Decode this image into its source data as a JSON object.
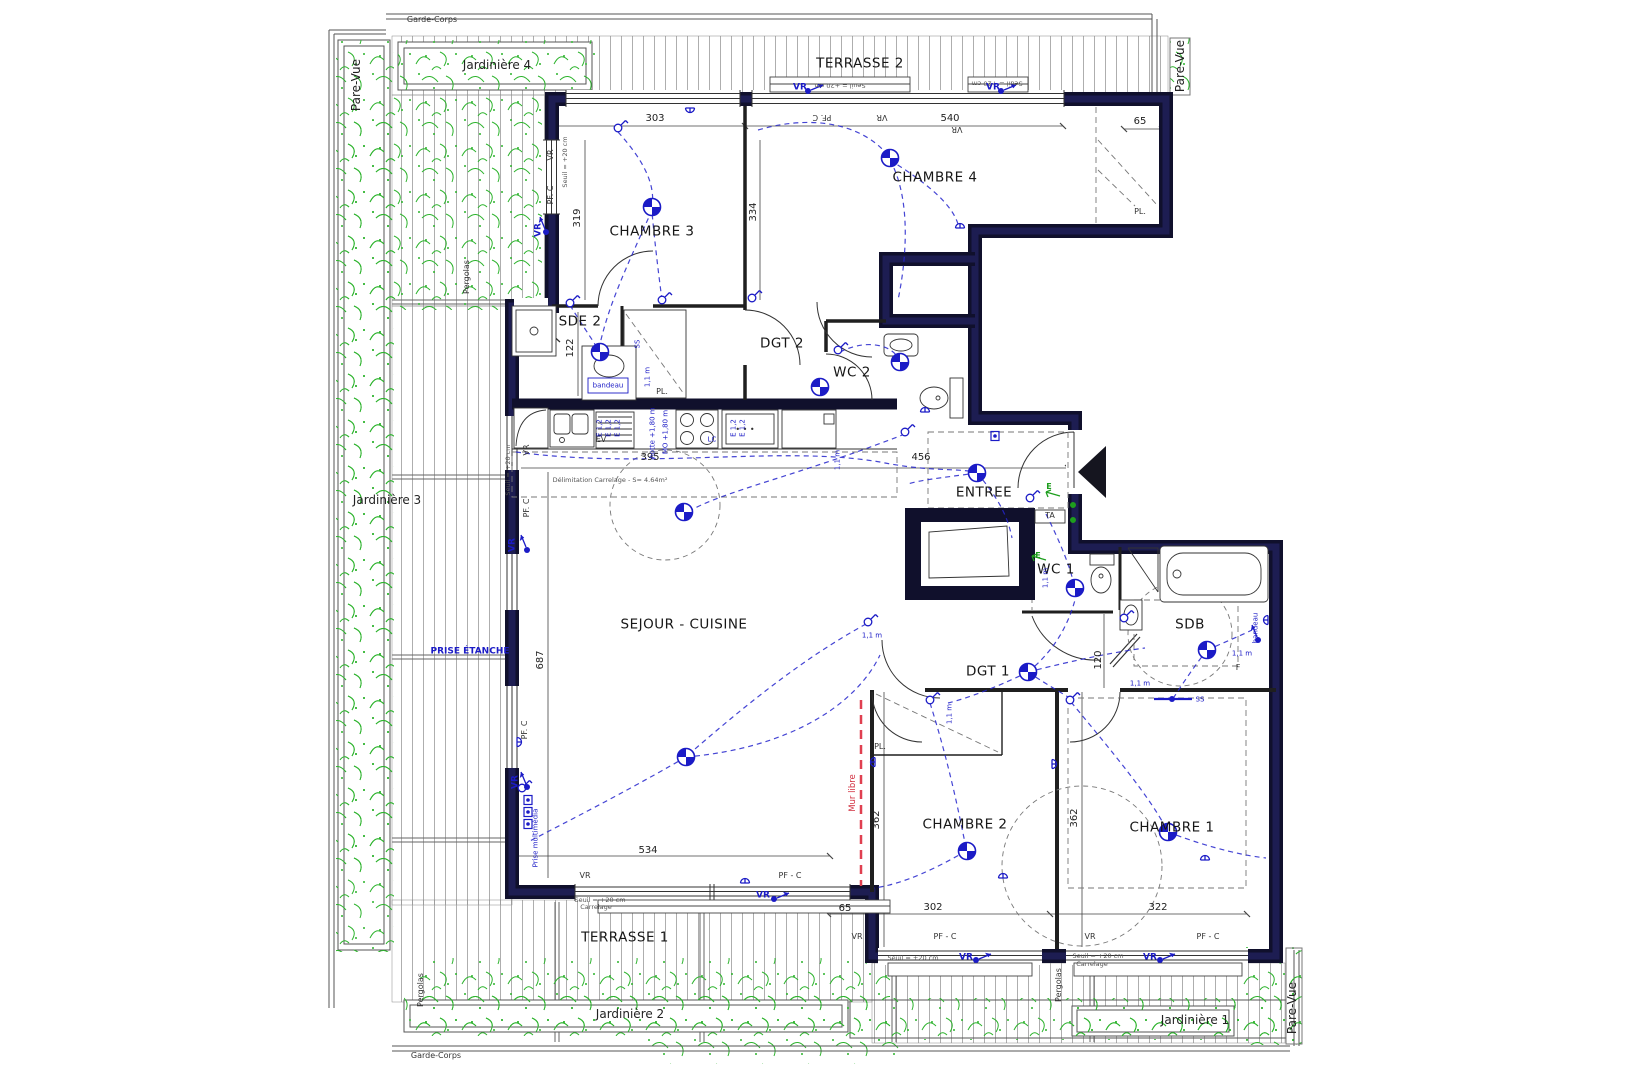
{
  "drawing": {
    "type": "floor-plan",
    "rooms": [
      "CHAMBRE 1",
      "CHAMBRE 2",
      "CHAMBRE 3",
      "CHAMBRE 4",
      "SEJOUR - CUISINE",
      "ENTREE",
      "DGT 1",
      "DGT 2",
      "WC 1",
      "WC 2",
      "SDE 2",
      "SDB"
    ],
    "outdoor": [
      "TERRASSE 1",
      "TERRASSE 2",
      "Jardinière 1",
      "Jardinière 2",
      "Jardinière 3",
      "Jardinière 4",
      "Pare-Vue",
      "Garde-Corps",
      "Pergolas"
    ],
    "dimensions_cm": [
      303,
      540,
      65,
      319,
      334,
      122,
      395,
      456,
      687,
      534,
      65,
      302,
      322,
      362,
      362,
      120
    ],
    "icons": [
      "ceiling-light-icon",
      "wall-switch-icon",
      "power-socket-icon",
      "roller-shutter-control-icon",
      "multimedia-socket-icon",
      "entrance-arrow-icon"
    ],
    "colors": {
      "wall": "#10102c",
      "electric": "#1b1bc6",
      "vegetation": "#2db32d",
      "deck_line": "#999999",
      "mur_libre": "#e04050"
    }
  },
  "labels": [
    {
      "t": "CHAMBRE 3",
      "x": 652,
      "y": 232,
      "c": "room"
    },
    {
      "t": "CHAMBRE 4",
      "x": 935,
      "y": 178,
      "c": "room"
    },
    {
      "t": "SDE 2",
      "x": 580,
      "y": 322,
      "c": "room"
    },
    {
      "t": "DGT 2",
      "x": 782,
      "y": 344,
      "c": "room"
    },
    {
      "t": "WC 2",
      "x": 852,
      "y": 373,
      "c": "room"
    },
    {
      "t": "ENTREE",
      "x": 984,
      "y": 493,
      "c": "room"
    },
    {
      "t": "SEJOUR - CUISINE",
      "x": 684,
      "y": 625,
      "c": "room"
    },
    {
      "t": "WC 1",
      "x": 1056,
      "y": 570,
      "c": "room"
    },
    {
      "t": "SDB",
      "x": 1190,
      "y": 625,
      "c": "room"
    },
    {
      "t": "DGT 1",
      "x": 988,
      "y": 672,
      "c": "room"
    },
    {
      "t": "CHAMBRE 2",
      "x": 965,
      "y": 825,
      "c": "room"
    },
    {
      "t": "CHAMBRE 1",
      "x": 1172,
      "y": 828,
      "c": "room"
    },
    {
      "t": "TERRASSE 2",
      "x": 860,
      "y": 64,
      "c": "room"
    },
    {
      "t": "TERRASSE 1",
      "x": 625,
      "y": 938,
      "c": "room"
    },
    {
      "t": "Jardinière 4",
      "x": 497,
      "y": 65,
      "c": "big"
    },
    {
      "t": "Jardinière 3",
      "x": 387,
      "y": 500,
      "c": "big"
    },
    {
      "t": "Jardinière 2",
      "x": 630,
      "y": 1014,
      "c": "big"
    },
    {
      "t": "Jardinière 1",
      "x": 1195,
      "y": 1020,
      "c": "big"
    },
    {
      "t": "Pare-Vue",
      "x": 356,
      "y": 85,
      "c": "big",
      "r": 90
    },
    {
      "t": "Pare-Vue",
      "x": 1180,
      "y": 66,
      "c": "big",
      "r": 90
    },
    {
      "t": "Pare-Vue",
      "x": 1292,
      "y": 1008,
      "c": "big",
      "r": 90
    },
    {
      "t": "Garde-Corps",
      "x": 432,
      "y": 20,
      "c": "tiny"
    },
    {
      "t": "Garde-Corps",
      "x": 436,
      "y": 1056,
      "c": "tiny"
    },
    {
      "t": "Pergolas",
      "x": 467,
      "y": 277,
      "c": "tiny",
      "r": 90
    },
    {
      "t": "Pergolas",
      "x": 421,
      "y": 990,
      "c": "tiny",
      "r": 90
    },
    {
      "t": "Pergolas",
      "x": 1059,
      "y": 985,
      "c": "tiny",
      "r": 90
    },
    {
      "t": "303",
      "x": 655,
      "y": 119,
      "c": "dim"
    },
    {
      "t": "540",
      "x": 950,
      "y": 119,
      "c": "dim"
    },
    {
      "t": "65",
      "x": 1140,
      "y": 122,
      "c": "dim"
    },
    {
      "t": "319",
      "x": 578,
      "y": 218,
      "c": "dim",
      "r": 90
    },
    {
      "t": "334",
      "x": 754,
      "y": 212,
      "c": "dim",
      "r": 90
    },
    {
      "t": "122",
      "x": 571,
      "y": 348,
      "c": "dim",
      "r": 90
    },
    {
      "t": "395",
      "x": 650,
      "y": 458,
      "c": "dim"
    },
    {
      "t": "456",
      "x": 921,
      "y": 458,
      "c": "dim"
    },
    {
      "t": "687",
      "x": 541,
      "y": 660,
      "c": "dim",
      "r": 90
    },
    {
      "t": "534",
      "x": 648,
      "y": 851,
      "c": "dim"
    },
    {
      "t": "65",
      "x": 845,
      "y": 909,
      "c": "dim"
    },
    {
      "t": "302",
      "x": 933,
      "y": 908,
      "c": "dim"
    },
    {
      "t": "322",
      "x": 1158,
      "y": 908,
      "c": "dim"
    },
    {
      "t": "362",
      "x": 877,
      "y": 820,
      "c": "dim",
      "r": 90
    },
    {
      "t": "362",
      "x": 1075,
      "y": 818,
      "c": "dim",
      "r": 90
    },
    {
      "t": "120",
      "x": 1099,
      "y": 660,
      "c": "dim",
      "r": 90
    },
    {
      "t": "PL.",
      "x": 1140,
      "y": 212,
      "c": "tiny"
    },
    {
      "t": "PL.",
      "x": 662,
      "y": 392,
      "c": "tiny"
    },
    {
      "t": "PL.",
      "x": 880,
      "y": 747,
      "c": "tiny"
    },
    {
      "t": "EV",
      "x": 601,
      "y": 440,
      "c": "tiny"
    },
    {
      "t": "• • •",
      "x": 745,
      "y": 430,
      "c": "tiny"
    },
    {
      "t": "F",
      "x": 1238,
      "y": 668,
      "c": "tiny"
    },
    {
      "t": "TA",
      "x": 1050,
      "y": 516,
      "c": "tiny"
    },
    {
      "t": "VR",
      "x": 551,
      "y": 155,
      "c": "tiny",
      "r": 90
    },
    {
      "t": "PF. C",
      "x": 551,
      "y": 195,
      "c": "tiny",
      "r": 90
    },
    {
      "t": "PF. C",
      "x": 822,
      "y": 117,
      "c": "tiny",
      "r": 180
    },
    {
      "t": "VR",
      "x": 882,
      "y": 117,
      "c": "tiny",
      "r": 180
    },
    {
      "t": "VR",
      "x": 957,
      "y": 129,
      "c": "tiny",
      "r": 180
    },
    {
      "t": "VR",
      "x": 527,
      "y": 450,
      "c": "tiny",
      "r": 90
    },
    {
      "t": "PF. C",
      "x": 527,
      "y": 508,
      "c": "tiny",
      "r": 90
    },
    {
      "t": "PF. C",
      "x": 525,
      "y": 730,
      "c": "tiny",
      "r": 90
    },
    {
      "t": "VR",
      "x": 585,
      "y": 876,
      "c": "tiny"
    },
    {
      "t": "PF - C",
      "x": 790,
      "y": 876,
      "c": "tiny"
    },
    {
      "t": "VR",
      "x": 857,
      "y": 937,
      "c": "tiny"
    },
    {
      "t": "PF - C",
      "x": 945,
      "y": 937,
      "c": "tiny"
    },
    {
      "t": "VR",
      "x": 1090,
      "y": 937,
      "c": "tiny"
    },
    {
      "t": "PF - C",
      "x": 1208,
      "y": 937,
      "c": "tiny"
    },
    {
      "t": "Seuil = +20 cm",
      "x": 840,
      "y": 85,
      "c": "t6",
      "r": 180
    },
    {
      "t": "Seuil = +20 cm",
      "x": 997,
      "y": 83,
      "c": "t6",
      "r": 180
    },
    {
      "t": "Seuil = +20 cm",
      "x": 913,
      "y": 958,
      "c": "t6"
    },
    {
      "t": "Seuil = +20 cm",
      "x": 1098,
      "y": 956,
      "c": "t6"
    },
    {
      "t": "Carrelage",
      "x": 1092,
      "y": 964,
      "c": "t6"
    },
    {
      "t": "Seuil = +20 cm",
      "x": 600,
      "y": 900,
      "c": "t6"
    },
    {
      "t": "Carrelage",
      "x": 596,
      "y": 907,
      "c": "t6"
    },
    {
      "t": "Seuil = +20 cm",
      "x": 508,
      "y": 470,
      "c": "t6",
      "r": 90
    },
    {
      "t": "Seuil = +20 cm",
      "x": 565,
      "y": 162,
      "c": "t6",
      "r": 90
    },
    {
      "t": "Délimitation Carrelage - S= 4.64m²",
      "x": 610,
      "y": 480,
      "c": "t6"
    },
    {
      "t": "Mur libre",
      "x": 853,
      "y": 793,
      "c": "red",
      "r": 90
    },
    {
      "t": "VR",
      "x": 800,
      "y": 88,
      "c": "blue"
    },
    {
      "t": "VR",
      "x": 993,
      "y": 88,
      "c": "blue"
    },
    {
      "t": "VR",
      "x": 539,
      "y": 230,
      "c": "blue",
      "r": 90
    },
    {
      "t": "VR",
      "x": 513,
      "y": 545,
      "c": "blue",
      "r": 90
    },
    {
      "t": "VR",
      "x": 516,
      "y": 782,
      "c": "blue",
      "r": 90
    },
    {
      "t": "VR",
      "x": 763,
      "y": 896,
      "c": "blue"
    },
    {
      "t": "VR",
      "x": 966,
      "y": 958,
      "c": "blue"
    },
    {
      "t": "VR",
      "x": 1150,
      "y": 958,
      "c": "blue"
    },
    {
      "t": "bandeau",
      "x": 608,
      "y": 386,
      "c": "bluet"
    },
    {
      "t": "bandeau",
      "x": 1256,
      "y": 628,
      "c": "bluet",
      "r": 90
    },
    {
      "t": "SS",
      "x": 638,
      "y": 344,
      "c": "bluet",
      "r": 90
    },
    {
      "t": "SS",
      "x": 1200,
      "y": 700,
      "c": "bluet"
    },
    {
      "t": "1,1 m",
      "x": 648,
      "y": 377,
      "c": "bluet",
      "r": 90
    },
    {
      "t": "1,1 m",
      "x": 838,
      "y": 460,
      "c": "bluet",
      "r": 90
    },
    {
      "t": "1,1 m",
      "x": 872,
      "y": 636,
      "c": "bluet"
    },
    {
      "t": "1,1 m",
      "x": 1046,
      "y": 578,
      "c": "bluet",
      "r": 90
    },
    {
      "t": "1,1 m",
      "x": 1140,
      "y": 684,
      "c": "bluet"
    },
    {
      "t": "1,1 m",
      "x": 1242,
      "y": 654,
      "c": "bluet"
    },
    {
      "t": "1,1 m",
      "x": 950,
      "y": 714,
      "c": "bluet",
      "r": 90
    },
    {
      "t": "E 1,2",
      "x": 600,
      "y": 428,
      "c": "bluet",
      "r": 90
    },
    {
      "t": "E 1,2",
      "x": 609,
      "y": 428,
      "c": "bluet",
      "r": 90
    },
    {
      "t": "E 1,2",
      "x": 618,
      "y": 428,
      "c": "bluet",
      "r": 90
    },
    {
      "t": "E 1,2",
      "x": 734,
      "y": 428,
      "c": "bluet",
      "r": 90
    },
    {
      "t": "E 1,2",
      "x": 743,
      "y": 428,
      "c": "bluet",
      "r": 90
    },
    {
      "t": "hotte +1,80 m",
      "x": 653,
      "y": 433,
      "c": "bluet",
      "r": 90
    },
    {
      "t": "MO +1,80 m",
      "x": 666,
      "y": 432,
      "c": "bluet",
      "r": 90
    },
    {
      "t": "LC",
      "x": 712,
      "y": 440,
      "c": "bluet"
    },
    {
      "t": "PRISE ÉTANCHE",
      "x": 470,
      "y": 652,
      "c": "blue"
    },
    {
      "t": "Prise multimédia",
      "x": 536,
      "y": 838,
      "c": "bluet",
      "r": 90
    },
    {
      "t": "E",
      "x": 1049,
      "y": 487,
      "c": "green"
    },
    {
      "t": "E",
      "x": 1038,
      "y": 556,
      "c": "green"
    }
  ]
}
